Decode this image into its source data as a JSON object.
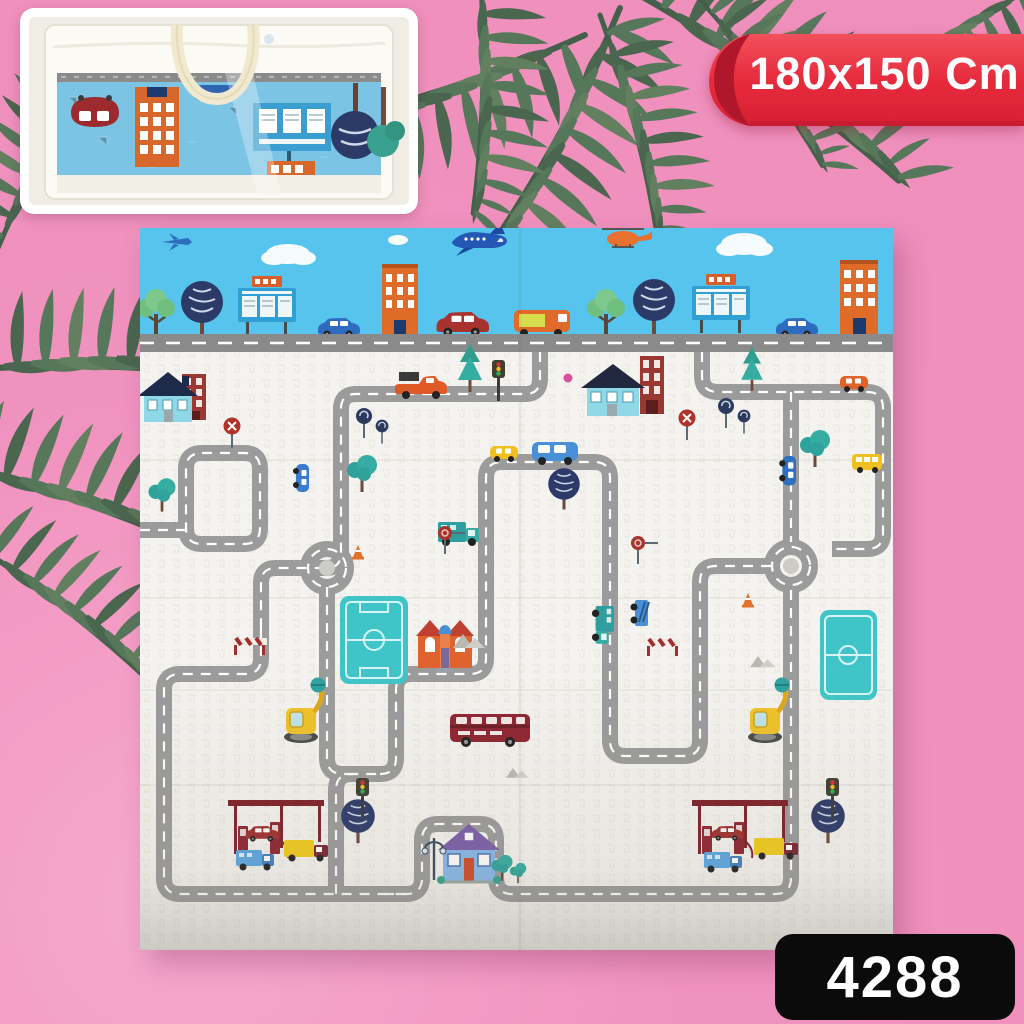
{
  "background": {
    "color": "#f092be"
  },
  "ribbon": {
    "label": "180x150 Cm",
    "color": "#e32638",
    "text_color": "#ffffff",
    "position": "top-right"
  },
  "badge": {
    "code": "4288",
    "bg_color": "#0b0b0b",
    "text_color": "#ffffff",
    "position": "bottom-right"
  },
  "inset": {
    "content": "folded-play-mat-in-clear-carry-bag",
    "bag_color": "#fbfaf5",
    "handle_color": "#f0e9cf",
    "visible_mat_color": "#7cc4e4",
    "visible_mat_items": [
      "red-car",
      "orange-building",
      "blue-car",
      "blue-sign-board",
      "orange-sign",
      "striped-navy-tree",
      "teal-tree"
    ]
  },
  "decor": {
    "leaf_color": "#57775b",
    "leaf_clusters": [
      "top-center",
      "top-right-corner",
      "under-ribbon",
      "left-edge",
      "behind-inset"
    ]
  },
  "mat": {
    "print": "city-road-map-play-mat",
    "colors": {
      "sky": "#56c4ec",
      "surface": "#f5f3ef",
      "road": "#9b9b9b",
      "road_dash": "#ffffff",
      "field": "#3fc5c8"
    },
    "sky_band_items": [
      "small-airplane",
      "large-airplane",
      "helicopter",
      "clouds",
      "green-trees",
      "striped-navy-trees",
      "billboards",
      "blue-cars",
      "orange-buildings",
      "dark-red-car",
      "orange-van",
      "street-road"
    ],
    "playfield_items": [
      "road-loops",
      "two-roundabouts",
      "blue-house-navy-roof",
      "brick-buildings",
      "orange-school-house",
      "blue-house-purple-roof",
      "two-soccer-fields",
      "double-decker-bus",
      "two-gas-stations",
      "fuel-pumps",
      "blue-delivery-trucks",
      "yellow-tank-trucks",
      "red-cars",
      "red-pickup-truck",
      "teal-trucks",
      "blue-van",
      "yellow-car",
      "school-bus",
      "excavator-cranes",
      "traffic-lights",
      "no-entry-signs",
      "stop-signs",
      "lollipop-trees",
      "teal-trees",
      "pine-trees",
      "navy-trees",
      "traffic-cones",
      "road-barriers",
      "gray-mountains",
      "street-lamp",
      "pink-ball"
    ]
  }
}
